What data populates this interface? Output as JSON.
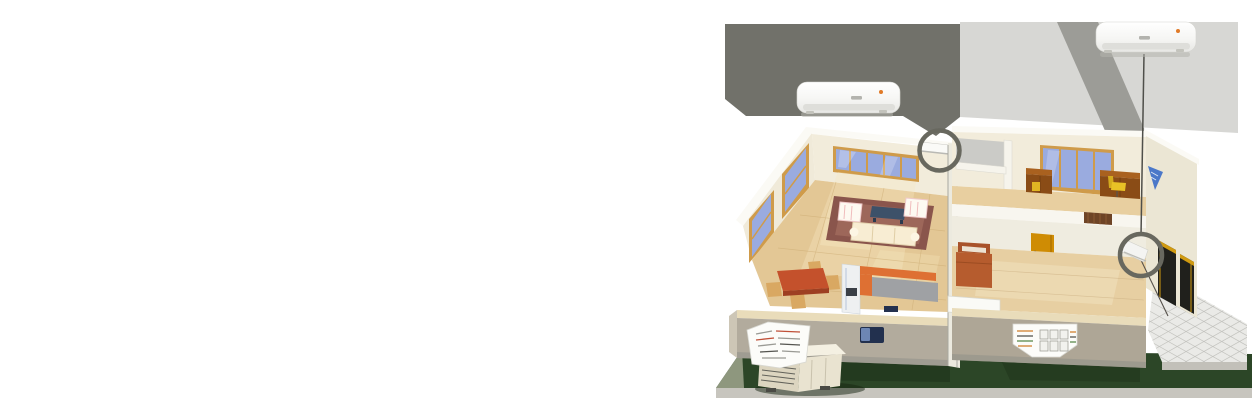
{
  "illustration": {
    "type": "isometric-house-cutaway-ac-placement",
    "objects": [
      "indoor-split-ac-unit-enlarged-left",
      "indoor-split-ac-unit-enlarged-right",
      "magnifier-circle-living-room",
      "magnifier-circle-bedroom",
      "living-room-with-sofa-rug-coffee-table",
      "dining-table-and-chairs",
      "kitchen-counters",
      "office-with-desks-and-chair",
      "bedroom-with-bed-and-door",
      "tiled-patio",
      "lawn-base",
      "outdoor-condenser-unit",
      "spec-callout-card-left",
      "spec-callout-card-right"
    ]
  },
  "colors": {
    "page_bg": "#ffffff",
    "beam_dark": "#71716a",
    "beam_mid": "#9c9c97",
    "beam_glow": "#d7d7d4",
    "magnifier_ring": "#68685f",
    "ac_body": "#fafaf9",
    "ac_indicator": "#e07a28",
    "wall_cream": "#f2ecdb",
    "wall_top_white": "#fbfaf5",
    "wall_front_gray": "#b2ab9d",
    "window_frame": "#cf9b4a",
    "window_glass": "#9aabdf",
    "floor_wood": "#e3c795",
    "rug": "#8a554c",
    "sofa": "#f8edd3",
    "coffee_table": "#3d5169",
    "dining_table": "#c4512c",
    "chair_tan": "#d9a862",
    "counter_orange": "#de7033",
    "counter_gray": "#9fa1a4",
    "bed": "#b65c2e",
    "door_amber": "#cf8c04",
    "desk_brown": "#a9611f",
    "chair_yellow": "#e8c226",
    "lawn": "#2c4627",
    "lawn_edge": "#c7c5be",
    "patio": "#eaeae7",
    "emblem_blue": "#3a6cc8",
    "dark_window": "#20201c"
  }
}
